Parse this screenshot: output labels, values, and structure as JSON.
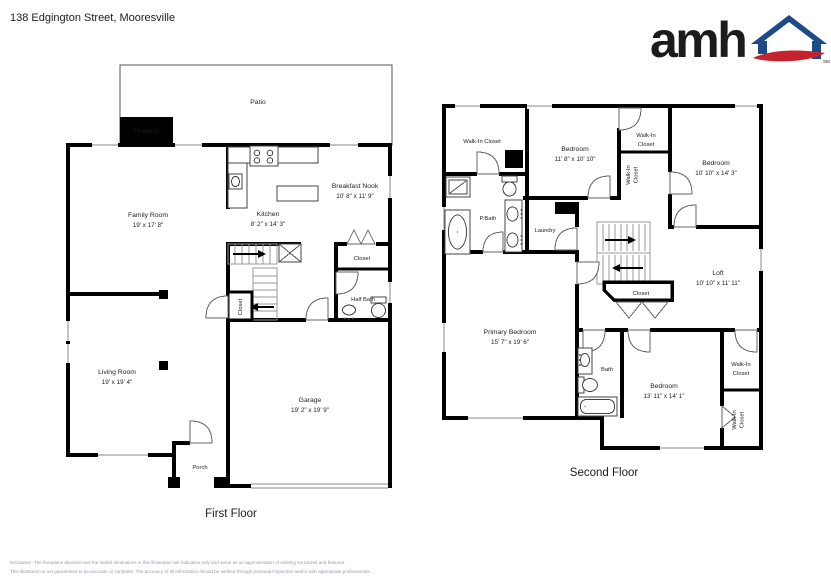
{
  "header": {
    "address": "138 Edgington Street, Mooresville",
    "logo": {
      "word": "amh",
      "tm": "SM"
    }
  },
  "colors": {
    "logo_blue": "#1d4b87",
    "logo_red": "#c5212e",
    "wall": "#000000",
    "disclaimer_text": "#959ab0"
  },
  "first_floor": {
    "caption": "First Floor",
    "labels": {
      "patio": "Patio",
      "fireplace": "Fireplace",
      "family_room": {
        "name": "Family Room",
        "dims": "19' x 17' 8\""
      },
      "kitchen": {
        "name": "Kitchen",
        "dims": "8' 2\" x 14' 3\""
      },
      "breakfast_nook": {
        "name": "Breakfast Nook",
        "dims": "10' 8\" x 11' 9\""
      },
      "closet": "Closet",
      "half_bath": "Half Bath",
      "stair_closet": "Closet",
      "living_room": {
        "name": "Living Room",
        "dims": "19' x 19' 4\""
      },
      "garage": {
        "name": "Garage",
        "dims": "19' 2\" x 19' 9\""
      },
      "porch": "Porch"
    }
  },
  "second_floor": {
    "caption": "Second Floor",
    "labels": {
      "walk_in_closet_nw": "Walk-In Closet",
      "bedroom_n": {
        "name": "Bedroom",
        "dims": "11' 8\" x 10' 10\""
      },
      "walk_in_closet_n": {
        "line1": "Walk-In",
        "line2": "Closet"
      },
      "walk_in_closet_mid": {
        "line1": "Walk-In",
        "line2": "Closet"
      },
      "bedroom_ne": {
        "name": "Bedroom",
        "dims": "10' 10\" x 14' 3\""
      },
      "p_bath": "P.Bath",
      "laundry": "Laundry",
      "loft": {
        "name": "Loft",
        "dims": "10' 10\" x 11' 11\""
      },
      "stair_closet": "Closet",
      "primary_bedroom": {
        "name": "Primary Bedroom",
        "dims": "15' 7\" x 19' 6\""
      },
      "bath": "Bath",
      "bedroom_se": {
        "name": "Bedroom",
        "dims": "13' 11\" x 14' 1\""
      },
      "walk_in_closet_e": {
        "line1": "Walk-In",
        "line2": "Closet"
      },
      "walk_in_closet_s": {
        "line1": "Walk-In",
        "line2": "Closet"
      }
    }
  },
  "disclaimer": {
    "line1": "Disclaimer: The floorplans depicted and the stated dimensions in this illustration are indicative only and serve as an approximation of existing structures and features.",
    "line2": "This illustration is not guaranteed to be accurate or complete. The accuracy of all information should be verified through personal inspection and/or with appropriate professionals."
  }
}
